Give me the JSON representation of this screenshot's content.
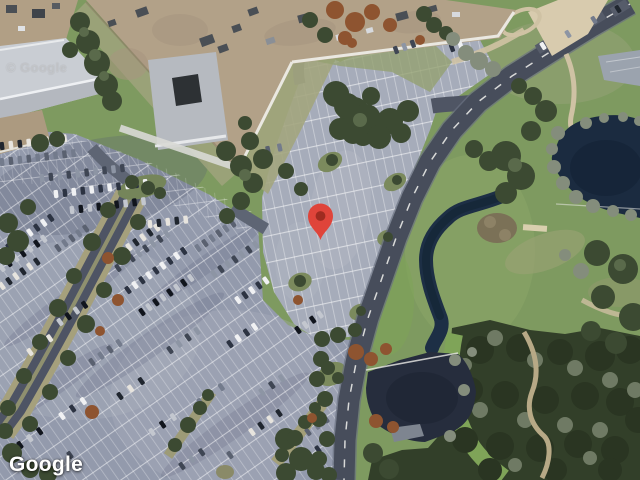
{
  "map": {
    "view": "satellite",
    "attribution": {
      "logo_text": "Google",
      "watermark_text": "© Google"
    },
    "marker": {
      "name": "location-pin",
      "pixel_x": 320.5,
      "pixel_y": 240,
      "transform": "translate(320.5,240)",
      "body_color": "#DF443A",
      "dot_color": "#9E2B20"
    }
  },
  "colors": {
    "grass": "#7E9A60",
    "forest": "#323F29",
    "water_dark": "#1B2B40",
    "pond_lower": "#262D3D",
    "parking_asphalt": "#939AAC",
    "parking_light": "#A6ACBA",
    "road": "#474D5B",
    "building_tan": "#B2A188",
    "roof_gray": "#C9CDD3",
    "logo_white": "#FFFFFF"
  },
  "scene": {
    "car_row_format": "[x, y, angle_deg, count, pitch_px]",
    "car_colors": [
      "#F0F1F3",
      "#20262F",
      "#3F4654",
      "#C3C7CF",
      "#737B8C",
      "#2C3342",
      "#E7E4DE",
      "#8D95A4",
      "#11151D",
      "#5A6170"
    ],
    "car_rows": [
      [
        2,
        252,
        -35,
        8,
        8.5
      ],
      [
        2,
        268,
        -35,
        7,
        8.5
      ],
      [
        2,
        286,
        -35,
        6,
        8.5
      ],
      [
        58,
        248,
        -35,
        5,
        8.5
      ],
      [
        118,
        268,
        -35,
        8,
        8.5
      ],
      [
        128,
        290,
        -35,
        9,
        8.5
      ],
      [
        142,
        312,
        -35,
        8,
        8.5
      ],
      [
        122,
        252,
        -35,
        6,
        8.5
      ],
      [
        198,
        248,
        -35,
        6,
        8.5
      ],
      [
        214,
        274,
        -35,
        7,
        8.5
      ],
      [
        238,
        300,
        -35,
        5,
        8.5
      ],
      [
        60,
        322,
        -35,
        4,
        10
      ],
      [
        30,
        352,
        -35,
        3,
        12
      ],
      [
        92,
        362,
        -35,
        4,
        11
      ],
      [
        170,
        350,
        -35,
        4,
        11
      ],
      [
        230,
        344,
        -35,
        4,
        10
      ],
      [
        298,
        330,
        -35,
        4,
        9
      ],
      [
        120,
        396,
        -35,
        3,
        13
      ],
      [
        200,
        402,
        -35,
        3,
        13
      ],
      [
        262,
        392,
        -35,
        3,
        12
      ],
      [
        62,
        416,
        -35,
        3,
        13
      ],
      [
        152,
        432,
        -35,
        3,
        13
      ],
      [
        252,
        432,
        -35,
        4,
        11
      ],
      [
        308,
        432,
        -35,
        3,
        11
      ],
      [
        182,
        466,
        -35,
        3,
        12
      ],
      [
        300,
        462,
        -35,
        3,
        11
      ],
      [
        20,
        445,
        -35,
        3,
        12
      ],
      [
        2,
        146,
        -7,
        8,
        9
      ],
      [
        2,
        162,
        -7,
        9,
        9
      ],
      [
        42,
        178,
        -7,
        10,
        9
      ],
      [
        56,
        194,
        -7,
        11,
        9
      ],
      [
        72,
        210,
        -7,
        9,
        9
      ],
      [
        150,
        224,
        -7,
        5,
        9
      ],
      [
        268,
        150,
        -12,
        2,
        12
      ],
      [
        396,
        50,
        -20,
        3,
        9
      ],
      [
        452,
        48,
        -20,
        2,
        9
      ]
    ],
    "single_cars": [
      [
        543,
        46,
        -32
      ],
      [
        568,
        34,
        -32
      ],
      [
        594,
        20,
        -32
      ],
      [
        618,
        9,
        -32
      ],
      [
        349,
        127,
        -12
      ],
      [
        320,
        355,
        -35
      ],
      [
        70,
        455,
        -35
      ],
      [
        230,
        455,
        -35
      ]
    ]
  }
}
